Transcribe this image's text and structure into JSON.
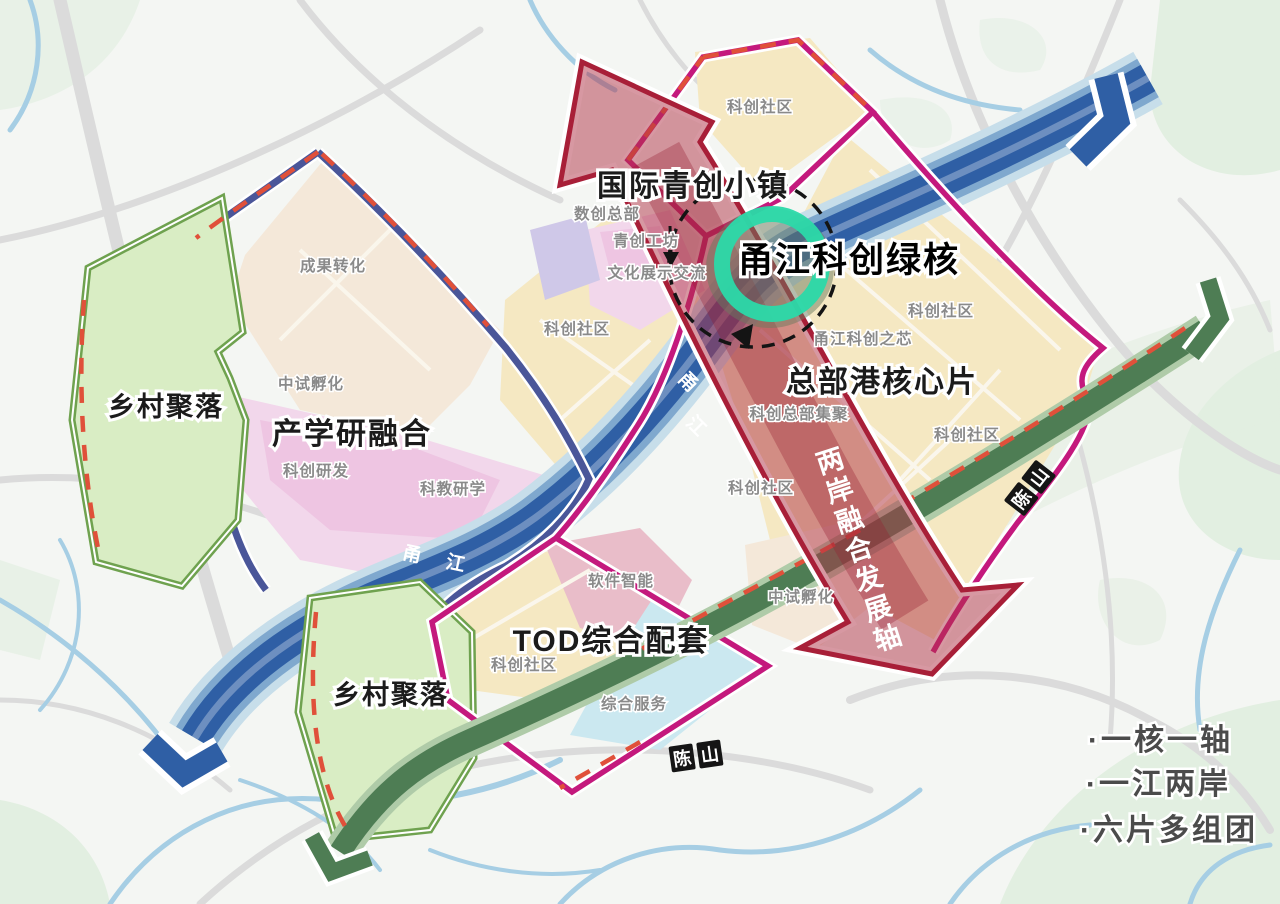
{
  "major_labels": {
    "town": "国际青创小镇",
    "green_core": "甬江科创绿核",
    "hq_port": "总部港核心片",
    "industry_research": "产学研融合",
    "village_west": "乡村聚落",
    "village_south": "乡村聚落",
    "tod": "TOD综合配套"
  },
  "axis_label": {
    "text": "两岸融合发展轴",
    "chars": [
      "两",
      "岸",
      "融",
      "合",
      "发",
      "展",
      "轴"
    ]
  },
  "area_labels": [
    {
      "text": "科创社区"
    },
    {
      "text": "数创总部"
    },
    {
      "text": "青创工坊"
    },
    {
      "text": "文化展示交流"
    },
    {
      "text": "科创社区"
    },
    {
      "text": "科创社区"
    },
    {
      "text": "甬江科创之芯"
    },
    {
      "text": "科创总部集聚"
    },
    {
      "text": "科创社区"
    },
    {
      "text": "科创社区"
    },
    {
      "text": "中试孵化"
    },
    {
      "text": "科创研发"
    },
    {
      "text": "科教研学"
    },
    {
      "text": "成果转化"
    },
    {
      "text": "软件智能"
    },
    {
      "text": "科创社区"
    },
    {
      "text": "综合服务"
    },
    {
      "text": "中试孵化"
    }
  ],
  "river": {
    "labels": [
      {
        "chars": [
          "甬",
          "江"
        ]
      },
      {
        "text": "甬 江"
      }
    ]
  },
  "corridor": {
    "labels": [
      {
        "chars": [
          "陈",
          "山"
        ]
      },
      {
        "chars": [
          "陈",
          "山"
        ]
      }
    ]
  },
  "legend": {
    "items": [
      {
        "label": "·一核一轴"
      },
      {
        "label": "·一江两岸"
      },
      {
        "label": "·六片多组团"
      }
    ]
  },
  "colors": {
    "river": "#2F5FA5",
    "river_mid": "#7FA8CE",
    "river_casing": "#C7DEEA",
    "corridor": "#4E7D54",
    "corridor_casing": "#AFCBA8",
    "axis_fill": "#B03246",
    "axis_stroke": "#A81F38",
    "boundary_magenta": "#C4197D",
    "boundary_navy": "#4A5699",
    "dash_red": "#E0503A",
    "green_core_ring": "#2BD9A9",
    "district_yellow": "#F5E8C2",
    "district_beige": "#F4E8D9",
    "district_pink": "#F2D7EB",
    "district_pink_strong": "#ECC0E0",
    "district_rose": "#E9BDC9",
    "district_cyan": "#CBE8F0",
    "district_green": "#D9EDC4",
    "village_border": "#6FA24F",
    "label_gray": "#8A8A8A",
    "legend_text": "#4B4B4B"
  }
}
